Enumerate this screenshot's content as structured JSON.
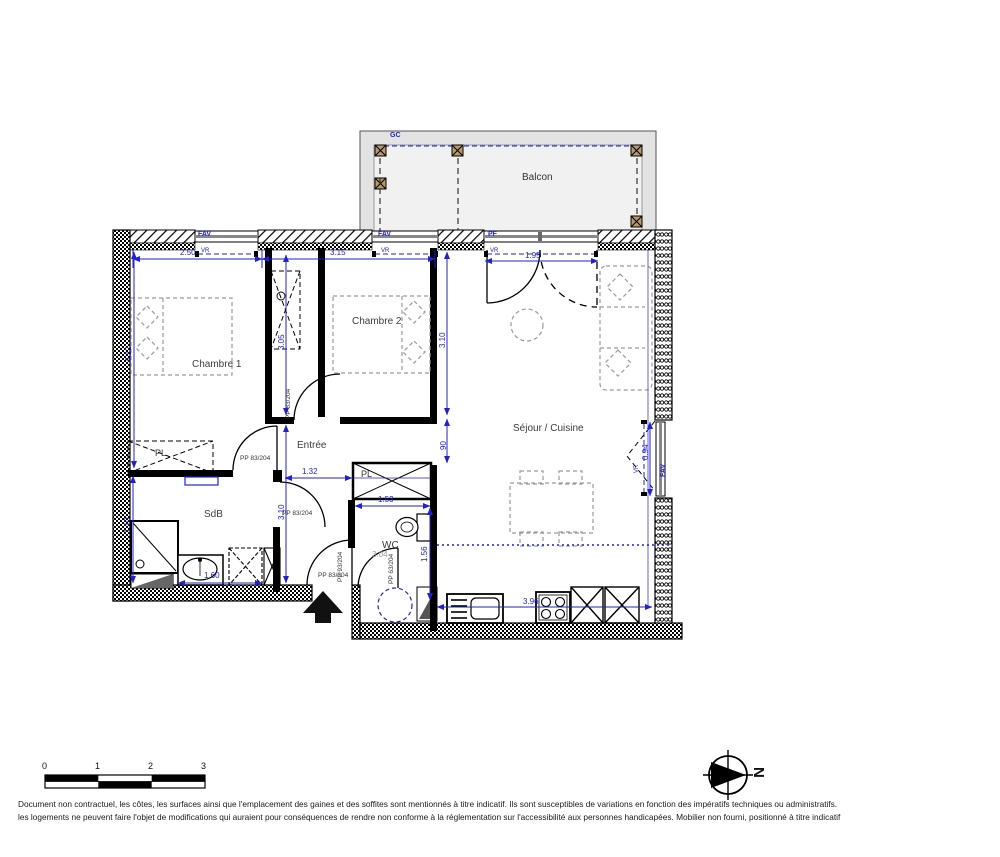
{
  "labels": {
    "balcon": "Balcon",
    "chambre1": "Chambre 1",
    "chambre2": "Chambre 2",
    "sejour": "Séjour / Cuisine",
    "entree": "Entrée",
    "sdb": "SdB",
    "wc": "WC",
    "wc_area": "3.04",
    "pl_sdb": "PL",
    "pl_wc": "PL"
  },
  "openings": {
    "gc": "GC",
    "fav1": "FAV",
    "vr1": "VR",
    "fav2": "FAV",
    "vr2": "VR",
    "pf": "PF",
    "vr3": "VR",
    "fav_right": "FAV",
    "vr_right": "VR"
  },
  "doors": {
    "chambre1": "PP 83/204",
    "chambre2": "PP 83/204",
    "sdb": "PP 83/204",
    "entrance_h": "PP 83/204",
    "entrance_v": "PP 93/204",
    "wc": "PP 63/204"
  },
  "dims": {
    "top_ch1": "2.50",
    "top_ch2": "3.15",
    "top_sejour": "1.95",
    "left_ch1": "4.12",
    "closet_v": "3.05",
    "hall_v": "3.10",
    "sejour_left_v": "3.10",
    "passage_v": "90",
    "hall_w": "1.32",
    "sdb_left_v": "1.10",
    "sdb_w": "1.60",
    "pl_w": "1.53",
    "wc_v": "1.56",
    "kitchen_w": "3.96",
    "win_right_v": "0.94"
  },
  "scalebar": {
    "t0": "0",
    "t1": "1",
    "t2": "2",
    "t3": "3"
  },
  "compass": {
    "north": "N"
  },
  "footer": {
    "line1": "Document non contractuel, les côtes, les surfaces ainsi que l'emplacement des gaines et des soffites sont mentionnés à titre indicatif. Ils sont susceptibles de variations en fonction des impératifs techniques ou administratifs.",
    "line2": "les logements ne peuvent faire l'objet de modifications qui auraient pour conséquences de rendre non conforme à la réglementation sur l'accessibilité aux personnes handicapées. Mobilier non fourni, positionné à titre indicatif"
  },
  "colors": {
    "dim_blue": "#2121cf",
    "wall_black": "#000000",
    "furniture_gray": "#9a9a9a",
    "balcony_gray": "#e3e3e3"
  }
}
